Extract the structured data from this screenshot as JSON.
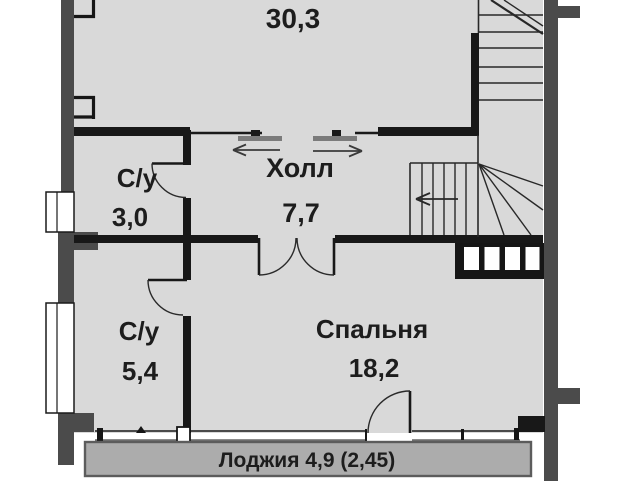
{
  "rooms": {
    "top": {
      "area": "30,3"
    },
    "bath_top": {
      "name": "С/у",
      "area": "3,0"
    },
    "hall": {
      "name": "Холл",
      "area": "7,7"
    },
    "bath_bottom": {
      "name": "С/у",
      "area": "5,4"
    },
    "bedroom": {
      "name": "Спальня",
      "area": "18,2"
    },
    "loggia": {
      "label": "Лоджия 4,9 (2,45)"
    }
  },
  "colors": {
    "floor": "#d9d9d9",
    "outer_wall": "#4b4b4b",
    "inner_wall": "#181818",
    "loggia_fill": "#acacac",
    "loggia_border": "#5c5c5c",
    "door_panel": "#7b7b7b",
    "text": "#1d1d1d"
  }
}
